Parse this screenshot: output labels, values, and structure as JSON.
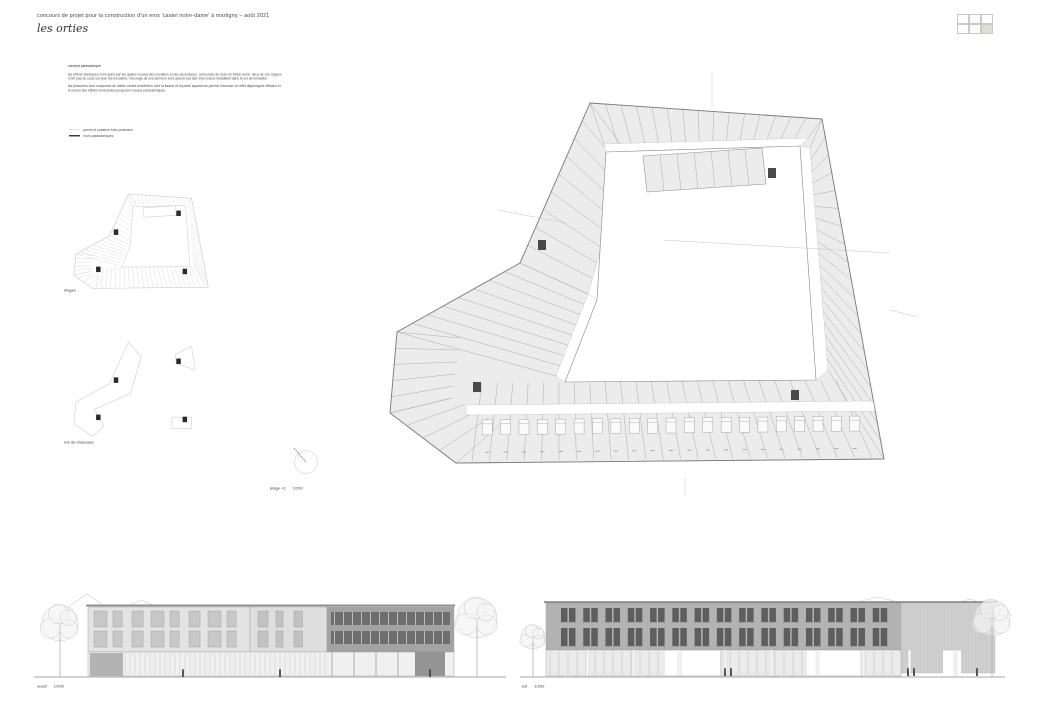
{
  "header": {
    "title": "concours de projet pour la construction d'un ems 'castel notre-dame' à martigny – août 2021",
    "project_name": "les orties"
  },
  "sheet_locator": {
    "rows": 2,
    "cols": 3,
    "active_row": 1,
    "active_col": 2,
    "active_color": "#dbe2cc"
  },
  "concept": {
    "heading": "concept parasismique",
    "body1": "les efforts sismiques sont repris par les quatre noyaux des escaliers et des ascenseurs, composés de murs en béton armé. deux de ces noyaux n'ont pas de sous-sol pour les encastrer, l'ancrage de ces derniers sera assuré par des micro-pieux travaillant dans le sol de fondation.",
    "body2": "les planchers sont composés de dalles mixtes bois/béton dont la liaison et la partie supérieure permet d'assurer un effet diaphragme efficace et le renvoi des efforts horizontaux jusqu'aux noyaux parasismiques."
  },
  "legend": {
    "items": [
      {
        "line_style": "dashed",
        "label": "parois et ossature bois porteuses"
      },
      {
        "line_style": "solid",
        "label": "murs parasismiques"
      }
    ]
  },
  "plans": {
    "etages_label": "étages",
    "rez_label": "rez-de-chaussée",
    "main_label": "étage +2",
    "main_scale": "1/200",
    "room_label": "chambre"
  },
  "elevations": [
    {
      "label": "ouest",
      "scale": "1/200"
    },
    {
      "label": "est",
      "scale": "1/200"
    }
  ],
  "colors": {
    "paper": "#ffffff",
    "plan_fill": "#ececec",
    "plan_line": "#8c8c8c",
    "partition": "#a5a5a5",
    "core": "#4a4a4a",
    "light_line": "#c8c8c8",
    "elev_dark": "#b4b4b4",
    "elev_light": "#e3e3e3",
    "window_dark": "#5e5e5e",
    "accent_green": "#dbe2cc"
  },
  "floor_plan": {
    "outer": [
      [
        220,
        43
      ],
      [
        452,
        59
      ],
      [
        514,
        399
      ],
      [
        86,
        403
      ],
      [
        20,
        353
      ],
      [
        27,
        272
      ],
      [
        150,
        203
      ]
    ],
    "courtyard": [
      [
        236,
        92
      ],
      [
        430,
        86
      ],
      [
        446,
        320
      ],
      [
        195,
        322
      ],
      [
        227,
        240
      ]
    ],
    "bar": {
      "pts": [
        [
          273,
          96
        ],
        [
          392,
          88
        ],
        [
          396,
          124
        ],
        [
          277,
          132
        ]
      ],
      "n": 7
    },
    "wings": [
      {
        "p": [
          [
            220,
            43
          ],
          [
            452,
            59
          ]
        ],
        "q": [
          [
            234,
            84
          ],
          [
            438,
            78
          ]
        ],
        "n": 15
      },
      {
        "p": [
          [
            452,
            59
          ],
          [
            514,
            399
          ]
        ],
        "q": [
          [
            440,
            88
          ],
          [
            458,
            310
          ]
        ],
        "n": 19
      },
      {
        "p": [
          [
            102,
            401
          ],
          [
            502,
            397
          ]
        ],
        "q": [
          [
            112,
            323
          ],
          [
            466,
            320
          ]
        ],
        "n": 23
      },
      {
        "p": [
          [
            220,
            43
          ],
          [
            150,
            203
          ]
        ],
        "q": [
          [
            258,
            94
          ],
          [
            218,
            234
          ]
        ],
        "n": 9
      },
      {
        "p": [
          [
            150,
            203
          ],
          [
            27,
            272
          ]
        ],
        "q": [
          [
            218,
            234
          ],
          [
            186,
            316
          ]
        ],
        "n": 8
      },
      {
        "p": [
          [
            27,
            272
          ],
          [
            20,
            353
          ]
        ],
        "q": [
          [
            90,
            278
          ],
          [
            82,
            338
          ]
        ],
        "n": 5
      },
      {
        "p": [
          [
            20,
            353
          ],
          [
            86,
            403
          ]
        ],
        "q": [
          [
            82,
            338
          ],
          [
            130,
            365
          ]
        ],
        "n": 4
      }
    ],
    "corridors": [
      [
        [
          234,
          84
        ],
        [
          438,
          78
        ],
        [
          430,
          86
        ],
        [
          236,
          92
        ]
      ],
      [
        [
          440,
          88
        ],
        [
          458,
          310
        ],
        [
          446,
          320
        ],
        [
          430,
          86
        ]
      ],
      [
        [
          258,
          94
        ],
        [
          218,
          234
        ],
        [
          227,
          240
        ],
        [
          236,
          92
        ]
      ],
      [
        [
          218,
          234
        ],
        [
          186,
          316
        ],
        [
          195,
          322
        ],
        [
          227,
          240
        ]
      ],
      [
        [
          96,
          355
        ],
        [
          505,
          351
        ],
        [
          505,
          341
        ],
        [
          96,
          345
        ]
      ]
    ],
    "cores": [
      [
        168,
        180
      ],
      [
        398,
        108
      ],
      [
        103,
        322
      ],
      [
        421,
        330
      ]
    ],
    "beds": {
      "from": [
        108,
        360
      ],
      "to": [
        494,
        356
      ],
      "count": 21
    },
    "leaders": [
      [
        342,
        12,
        342,
        46
      ],
      [
        315,
        418,
        315,
        436
      ],
      [
        293,
        180,
        520,
        193
      ],
      [
        520,
        250,
        548,
        257
      ],
      [
        128,
        150,
        196,
        163
      ]
    ]
  },
  "mini": {
    "sx": 0.272,
    "sy": 0.262,
    "ox": 20,
    "oy": 43,
    "dx": 6,
    "dy": 4,
    "rez": {
      "band": [
        [
          220,
          43
        ],
        [
          150,
          203
        ],
        [
          27,
          272
        ],
        [
          20,
          353
        ],
        [
          86,
          403
        ],
        [
          130,
          365
        ],
        [
          95,
          300
        ],
        [
          227,
          240
        ],
        [
          267,
          100
        ]
      ],
      "fragment": [
        [
          392,
          91
        ],
        [
          452,
          59
        ],
        [
          466,
          150
        ],
        [
          396,
          125
        ]
      ],
      "annex": [
        [
          380,
          330
        ],
        [
          452,
          330
        ],
        [
          452,
          374
        ],
        [
          380,
          374
        ]
      ],
      "dot_step": 7
    }
  },
  "elev_geo": {
    "west": {
      "ground": [
        4,
        476
      ],
      "gables": [
        "M38,40 L38,22 L57,9 L76,22 L76,40",
        "M76,31 L111,15 L147,30",
        "M147,30 L147,40"
      ],
      "blocks": [
        {
          "x": 58,
          "w": 162,
          "fill": "#e3e3e3",
          "winfill": "#c8c8c8",
          "floors": [
            26,
            46
          ],
          "wh": 16,
          "ww": 13,
          "gap": 6,
          "type": "grid"
        },
        {
          "x": 220,
          "w": 77,
          "fill": "#dedede",
          "winfill": "#c2c2c2",
          "floors": [
            26,
            46
          ],
          "wh": 16,
          "ww": 10,
          "gap": 8,
          "type": "grid"
        },
        {
          "x": 297,
          "w": 127,
          "fill": "#a3a3a3",
          "type": "bands",
          "bands": [
            [
              27,
              13
            ],
            [
              46,
              13
            ]
          ]
        }
      ],
      "trees": [
        {
          "x": 30,
          "cy": 38,
          "r": 18
        },
        {
          "x": 447,
          "cy": 33,
          "r": 20
        }
      ],
      "figures": [
        153,
        250,
        400
      ]
    },
    "east": {
      "ground": [
        5,
        490
      ],
      "gables": [
        "M300,28 L362,12 L424,26",
        "M404,30 L455,14 L497,30"
      ],
      "building": {
        "x1": 31,
        "x2": 480,
        "top": 18,
        "gf": 65,
        "bot": 91
      },
      "right_light_x": 386,
      "pairs": {
        "start": 46,
        "end": 380,
        "count": 15,
        "rows": [
          [
            23,
            14
          ],
          [
            43,
            18
          ]
        ]
      },
      "white_openings": [
        [
          150,
          55
        ],
        [
          292,
          53
        ],
        [
          428,
          18
        ]
      ],
      "trees": [
        {
          "x": 18,
          "cy": 52,
          "r": 12
        },
        {
          "x": 477,
          "cy": 33,
          "r": 18
        }
      ],
      "figures": [
        210,
        216,
        393,
        399,
        462
      ]
    }
  }
}
